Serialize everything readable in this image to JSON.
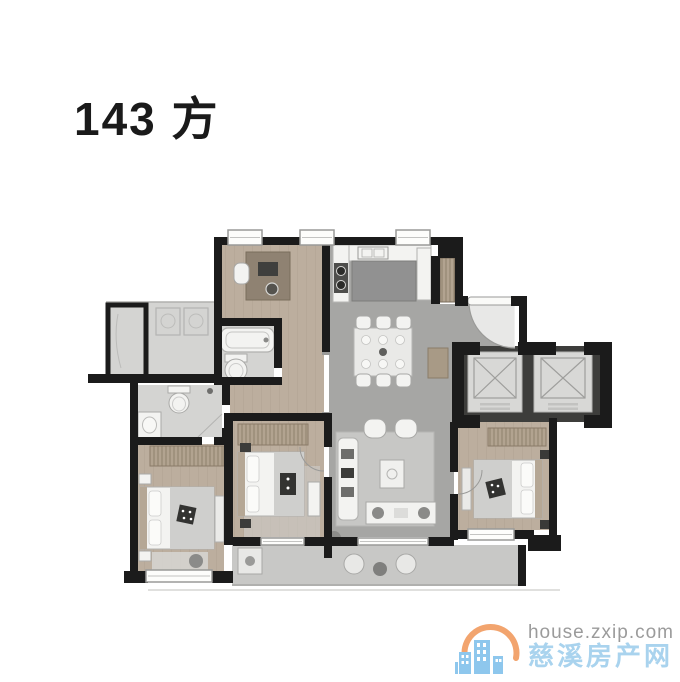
{
  "page": {
    "title": "143 方",
    "background": "#ffffff"
  },
  "floorplan": {
    "label": "apartment-floor-plan",
    "colors": {
      "wall": "#1b1b1b",
      "wood_floor": "#bcae9e",
      "wood_line": "#a3947f",
      "gray_floor": "#a6a6a4",
      "light_floor": "#d4d4d2",
      "balcony_floor": "#c8c8c6",
      "rug": "#c7c7c5",
      "furniture": "#f3f3f1",
      "furniture_line": "#a8a8a6",
      "blanket": "#cfcfcd",
      "dark_item": "#333331",
      "wardrobe": "#b2a390",
      "wardrobe_line": "#857662",
      "elevator_wall": "#3d3d3b",
      "elevator_car": "#d8d8d6",
      "elevator_line": "#9e9e9c",
      "window_line": "#9a9a98"
    },
    "features": [
      "study-desk-icon",
      "kitchen-counter-icon",
      "stove-icon",
      "kitchen-island-icon",
      "dining-table-icon",
      "entry-door-arc-icon",
      "coat-closet-icon",
      "elevator-icon",
      "elevator-icon",
      "bathtub-icon",
      "toilet-icon",
      "toilet-icon",
      "vanity-sink-icon",
      "washer-icon",
      "bed-icon",
      "bed-icon",
      "bed-icon",
      "wardrobe-icon",
      "sofa-icon",
      "coffee-table-icon",
      "tv-console-icon",
      "balcony-chairs-icon"
    ]
  },
  "watermark": {
    "url_text": "house.zxip.com",
    "site_name": "慈溪房产网",
    "colors": {
      "url_text": "#9b9b9b",
      "site_name": "#a9d3ee",
      "logo_blue": "#8ec7ed",
      "logo_orange": "#f2a46e"
    }
  }
}
